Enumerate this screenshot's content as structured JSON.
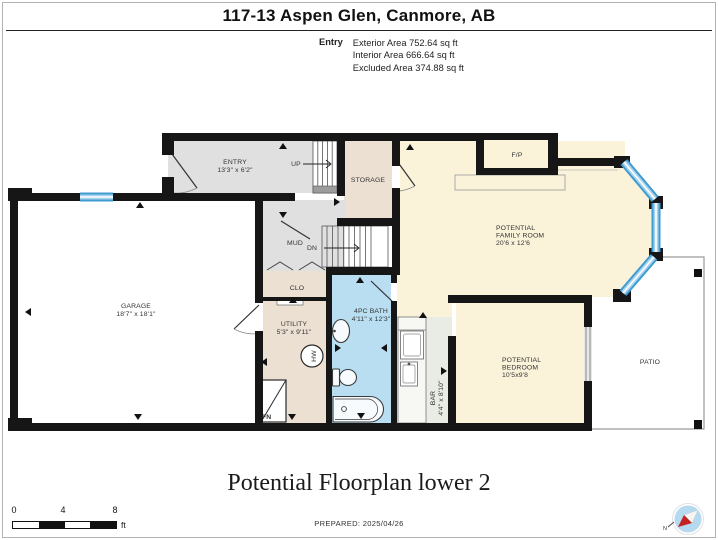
{
  "page": {
    "title": "117-13 Aspen Glen, Canmore, AB",
    "floor_title": "Potential Floorplan lower 2",
    "prepared": "PREPARED: 2025/04/26"
  },
  "area_summary": {
    "label": "Entry",
    "lines": [
      "Exterior Area 752.64 sq ft",
      "Interior Area 666.64 sq ft",
      "Excluded Area 374.88 sq ft"
    ]
  },
  "scale_bar": {
    "ticks": [
      "0",
      "4",
      "8"
    ],
    "unit": "ft"
  },
  "compass": {
    "north": "N"
  },
  "plan": {
    "rooms": {
      "entry": {
        "name": "ENTRY",
        "dims": "13'3\" x 6'2\""
      },
      "storage": {
        "name": "STORAGE"
      },
      "mud": {
        "name": "MUD"
      },
      "clo": {
        "name": "CLO"
      },
      "utility": {
        "name": "UTILITY",
        "dims": "5'3\" x 9'11\""
      },
      "garage": {
        "name": "GARAGE",
        "dims": "18'7\" x 18'1\""
      },
      "bath": {
        "name": "4PC BATH",
        "dims": "4'11\" x 12'3\""
      },
      "bar": {
        "name": "BAR",
        "dims": "4'4\" x 8'10\""
      },
      "family": {
        "line1": "POTENTIAL",
        "line2": "FAMILY ROOM",
        "dims": "20'6 x 12'6"
      },
      "bedroom": {
        "line1": "POTENTIAL",
        "line2": "BEDROOM",
        "dims": "10'5x9'8"
      },
      "patio": {
        "name": "PATIO"
      },
      "fireplace": {
        "name": "F/P"
      }
    },
    "stairs": {
      "up": "UP",
      "down": "DN"
    },
    "fixtures": {
      "furnace": "FN",
      "water_heater": "HW"
    }
  },
  "plan_colors": {
    "wall": "#161616",
    "room_gray": "#e0e0e0",
    "room_beige": "#ece0d2",
    "room_cream": "#faf3da",
    "room_bath_blue": "#b9def1",
    "room_counter_floor": "#e8ece4",
    "stair_fill": "#ededed",
    "window_blue": "#3f9cd3",
    "window_light": "#a8d3ee",
    "compass_fill": "#b5d9ee",
    "compass_red": "#c42222"
  }
}
